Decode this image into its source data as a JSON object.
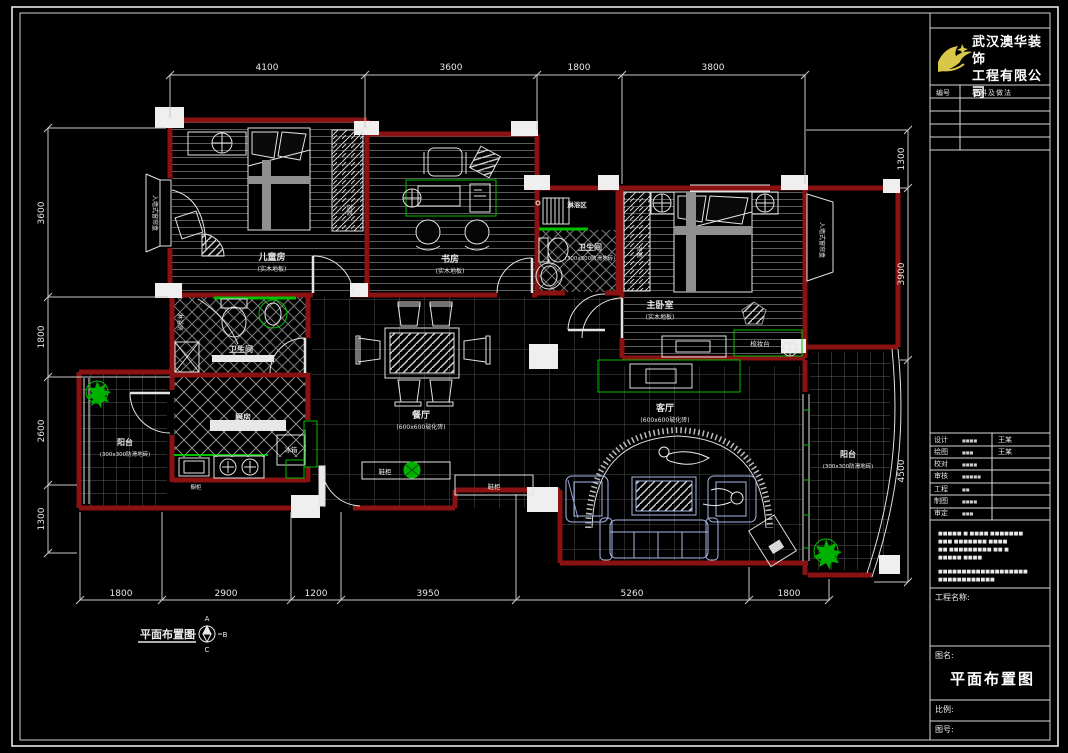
{
  "title_block": {
    "company_line1": "武汉澳华装饰",
    "company_line2": "工程有限公司",
    "materials_header": {
      "no": "编号",
      "desc": "材料及做法"
    },
    "sign_rows": [
      {
        "label": "设计",
        "value": "■■■■",
        "name": "王某"
      },
      {
        "label": "绘图",
        "value": "■■■",
        "name": "王某"
      },
      {
        "label": "校对",
        "value": "■■■■",
        "name": ""
      },
      {
        "label": "审核",
        "value": "■■■■■",
        "name": ""
      },
      {
        "label": "工程",
        "value": "■■",
        "name": ""
      },
      {
        "label": "制图",
        "value": "■■■■",
        "name": ""
      },
      {
        "label": "审定",
        "value": "■■■",
        "name": ""
      }
    ],
    "notes_lines": [
      "■■■■■ ■ ■■■■ ■■■■■■■",
      "■■■ ■■■■■■■ ■■■■",
      "■■ ■■■■■■■■■ ■■ ■",
      "■■■■■ ■■■■",
      "■■■■■■■■■■■■■■■■■■■",
      "■■■■■■■■■■■■"
    ],
    "project_label": "工程名称:",
    "name_label": "图名:",
    "drawing_title": "平面布置图",
    "scale_label": "比例:",
    "number_label": "图号:"
  },
  "plan": {
    "caption": "平面布置图",
    "compass": {
      "top": "A",
      "right": "B",
      "bottom": "C",
      "left": "D"
    },
    "rooms": {
      "children": {
        "name": "儿童房",
        "sub": "(实木地板)"
      },
      "study": {
        "name": "书房",
        "sub": "(实木地板)"
      },
      "master": {
        "name": "主卧室",
        "sub": "(实木地板)"
      },
      "shower": {
        "name": "淋浴区"
      },
      "bath1": {
        "name": "卫生间",
        "sub": "(300x300防滑地砖)"
      },
      "bath2": {
        "name": "卫生间",
        "sub": "(300x300防滑地砖)"
      },
      "kitchen": {
        "name": "厨房"
      },
      "dining": {
        "name": "餐厅",
        "sub": "(600x600玻化砖)"
      },
      "living": {
        "name": "客厅",
        "sub": "(600x600玻化砖)"
      },
      "balcony_left": {
        "name": "阳台",
        "sub": "(300x300防滑地砖)"
      },
      "balcony_right": {
        "name": "阳台",
        "sub": "(300x300防滑地砖)"
      }
    },
    "furniture": {
      "wardrobe_child": "衣柜",
      "wardrobe_master": "衣柜",
      "dresser": "梳妆台",
      "fridge": "冰箱",
      "shower_room": "淋浴房",
      "counter": "橱柜",
      "shoe1": "鞋柜",
      "shoe2": "鞋柜",
      "curtain_master": "入墙式窗帘盒",
      "curtain_child": "入墙式窗帘盒"
    },
    "dims": {
      "top": [
        "4100",
        "3600",
        "1800",
        "3800"
      ],
      "bottom": [
        "1800",
        "2900",
        "1200",
        "3950",
        "5260",
        "1800"
      ],
      "left": [
        "3600",
        "1800",
        "2600",
        "1300"
      ],
      "right": [
        "1300",
        "3900",
        "4500"
      ]
    }
  },
  "colors": {
    "wall": "#8a1212",
    "green": "#00c000",
    "logo_yellow": "#d8c84a",
    "sofa_tint": "#a9b9e6"
  }
}
